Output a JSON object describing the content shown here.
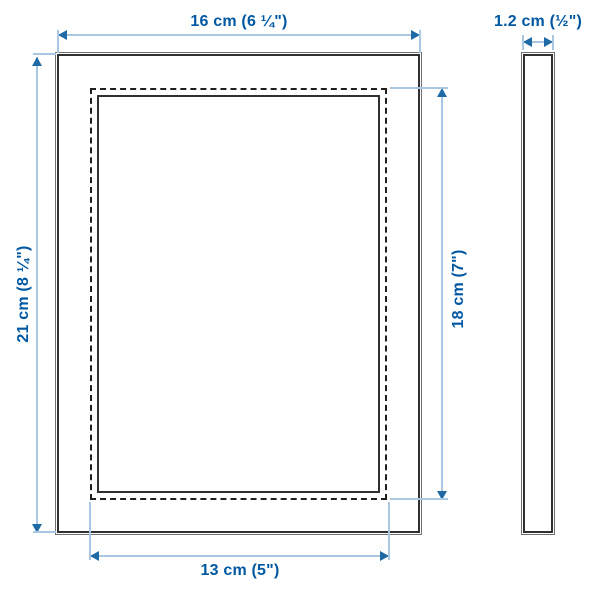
{
  "diagram": {
    "product": "picture-frame-dimension-drawing",
    "views": {
      "front": "frame-front-view",
      "side": "frame-side-view"
    },
    "dimensions": {
      "outer_width_label": "16 cm (6 ¼\")",
      "outer_height_label": "21 cm (8 ¼\")",
      "opening_width_label": "13 cm (5\")",
      "opening_height_label": "18 cm (7\")",
      "depth_label": "1.2 cm (½\")"
    },
    "colors": {
      "dimension_text": "#0058a3",
      "dimension_line": "#a9c7e0",
      "dimension_arrow": "#1f6aa5",
      "frame_outline": "#303030"
    }
  }
}
